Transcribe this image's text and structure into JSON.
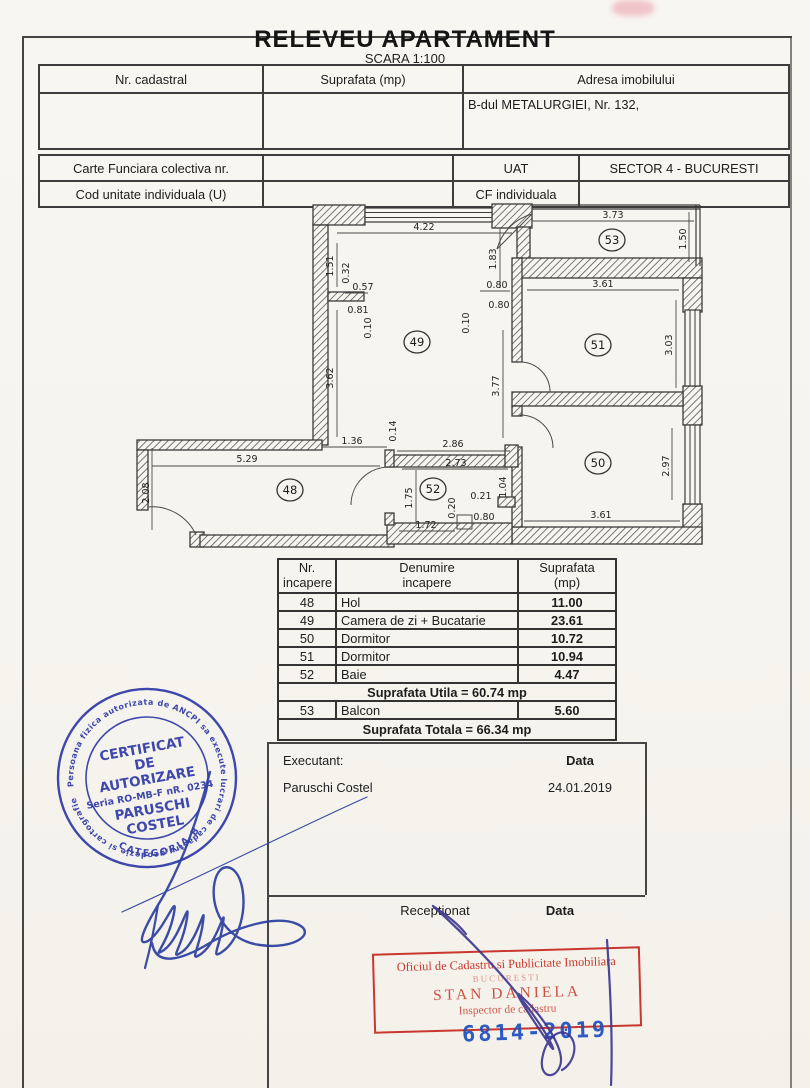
{
  "header": {
    "title": "RELEVEU APARTAMENT",
    "scale": "SCARA 1:100"
  },
  "table1": {
    "col1": "Nr. cadastral",
    "col2": "Suprafata (mp)",
    "col3": "Adresa imobilului",
    "address": "B-dul METALURGIEI, Nr. 132,"
  },
  "table2": {
    "carte": "Carte Funciara colectiva nr.",
    "uat": "UAT",
    "sector": "SECTOR 4 - BUCURESTI",
    "cod": "Cod unitate individuala (U)",
    "cf": "CF individuala"
  },
  "plan": {
    "rooms": {
      "r48": "48",
      "r49": "49",
      "r50": "50",
      "r51": "51",
      "r52": "52",
      "r53": "53"
    },
    "dims": {
      "d422": "4.22",
      "d373": "3.73",
      "d150": "1.50",
      "d151": "1.51",
      "d032": "0.32",
      "d057": "0.57",
      "d081": "0.81",
      "d010a": "0.10",
      "d183": "1.83",
      "d080a": "0.80",
      "d080b": "0.80",
      "d010b": "0.10",
      "d361a": "3.61",
      "d303": "3.03",
      "d362": "3.62",
      "d377": "3.77",
      "d136": "1.36",
      "d014": "0.14",
      "d286": "2.86",
      "d273": "2.73",
      "d529": "5.29",
      "d208": "2.08",
      "d175": "1.75",
      "d020": "0.20",
      "d021": "0.21",
      "d104": "1.04",
      "d080c": "0.80",
      "d172": "1.72",
      "d297": "2.97",
      "d361b": "3.61"
    }
  },
  "room_table": {
    "headers": {
      "c1a": "Nr.",
      "c1b": "incapere",
      "c2a": "Denumire",
      "c2b": "incapere",
      "c3a": "Suprafata",
      "c3b": "(mp)"
    },
    "rows": [
      {
        "nr": "48",
        "name": "Hol",
        "area": "11.00"
      },
      {
        "nr": "49",
        "name": "Camera de zi + Bucatarie",
        "area": "23.61"
      },
      {
        "nr": "50",
        "name": "Dormitor",
        "area": "10.72"
      },
      {
        "nr": "51",
        "name": "Dormitor",
        "area": "10.94"
      },
      {
        "nr": "52",
        "name": "Baie",
        "area": "4.47"
      }
    ],
    "utila": "Suprafata Utila = 60.74 mp",
    "balcon": {
      "nr": "53",
      "name": "Balcon",
      "area": "5.60"
    },
    "totala": "Suprafata Totala = 66.34 mp"
  },
  "executant": {
    "label": "Executant:",
    "name": "Paruschi Costel",
    "data_label": "Data",
    "date": "24.01.2019"
  },
  "receptie": {
    "label": "Receptionat",
    "data_label": "Data"
  },
  "blue_stamp": {
    "ring": "Persoana fizica autorizata de ANCPI sa execute lucrari de cadastru,geodezie si cartografie",
    "l1": "CERTIFICAT",
    "l2": "DE",
    "l3": "AUTORIZARE",
    "l4": "Seria RO-MB-F nR. 0234",
    "l5": "PARUSCHI",
    "l6": "COSTEL",
    "l7": "CATEGORIA B",
    "color": "#2b35a5"
  },
  "red_stamp": {
    "l1": "Oficiul de Cadastru si Publicitate Imobiliara",
    "l2": "BUCURESTI",
    "l3": "STAN DANIELA",
    "l4": "Inspector de cadastru",
    "color": "#c9382e"
  },
  "date_stamp": {
    "value": "6814-2019",
    "color": "#1d4fc0"
  }
}
